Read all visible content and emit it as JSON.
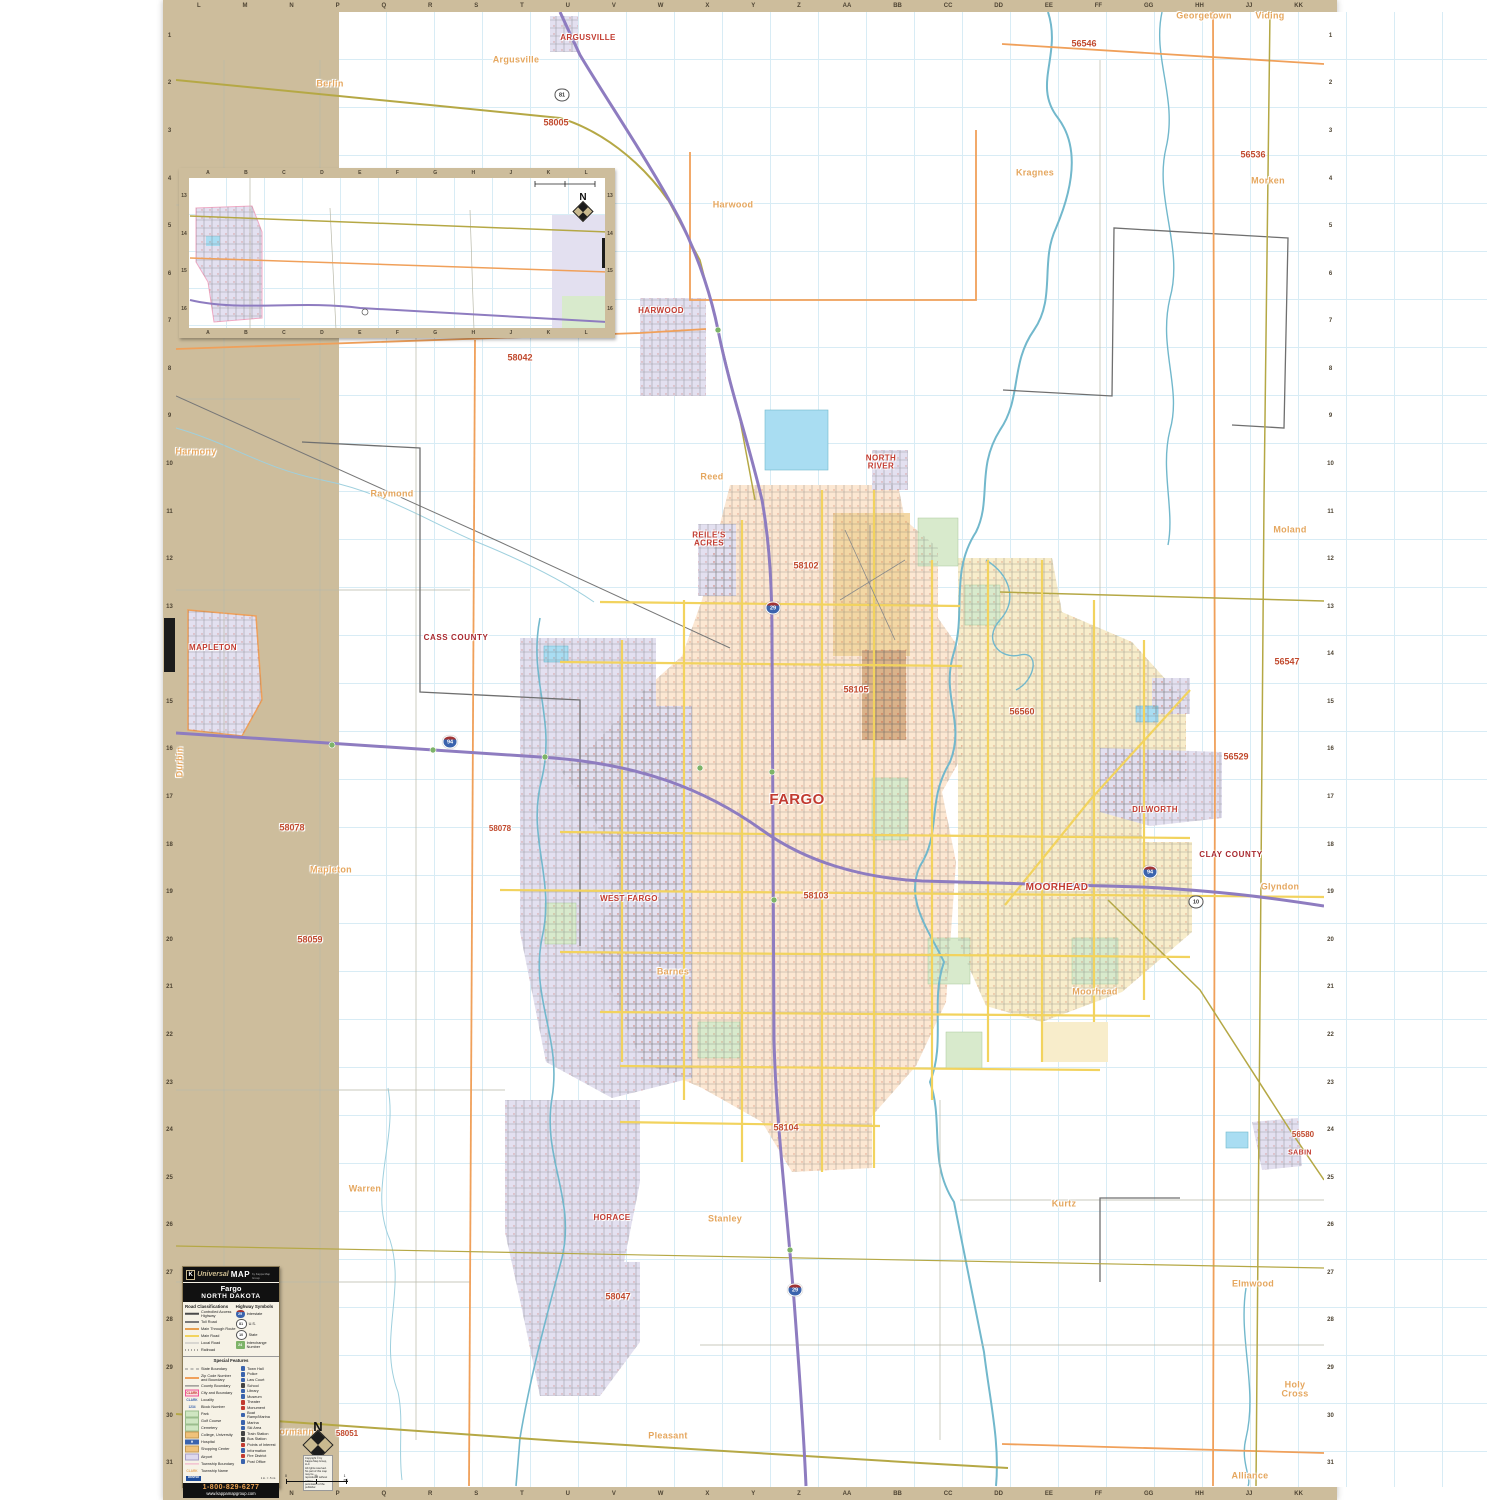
{
  "title": "Fargo North Dakota Wall Map",
  "colors": {
    "frame": "#cdbd9c",
    "urban_peach": "#fce7d2",
    "city_lavender": "#e3e0f0",
    "moorhead_yellow": "#f8edcb",
    "park_green": "#d8eacc",
    "water_cyan": "#a9ddf2",
    "river": "#72b8cc",
    "interstate_purple": "#8e7cc0",
    "main_road_yellow": "#f2d35e",
    "through_route_olive": "#b5a845",
    "zip_boundary_orange": "#f0a05a",
    "city_label_red": "#c23b30",
    "zip_label_red": "#c14a2e",
    "township_tan": "#e5a75f"
  },
  "north": {
    "label": "N"
  },
  "grid": {
    "top_letters": [
      "L",
      "M",
      "N",
      "P",
      "Q",
      "R",
      "S",
      "T",
      "U",
      "V",
      "W",
      "X",
      "Y",
      "Z",
      "AA",
      "BB",
      "CC",
      "DD",
      "EE",
      "FF",
      "GG",
      "HH",
      "JJ",
      "KK"
    ],
    "side_numbers": [
      "1",
      "2",
      "3",
      "4",
      "5",
      "6",
      "7",
      "8",
      "9",
      "10",
      "11",
      "12",
      "13",
      "14",
      "15",
      "16",
      "17",
      "18",
      "19",
      "20",
      "21",
      "22",
      "23",
      "24",
      "25",
      "26",
      "27",
      "28",
      "29",
      "30",
      "31"
    ]
  },
  "inset": {
    "letters": [
      "A",
      "B",
      "C",
      "D",
      "E",
      "F",
      "G",
      "H",
      "J",
      "K",
      "L"
    ],
    "numbers": [
      "13",
      "14",
      "15",
      "16"
    ]
  },
  "shields": [
    {
      "type": "interstate",
      "num": "29",
      "x": 773,
      "y": 608
    },
    {
      "type": "interstate",
      "num": "29",
      "x": 795,
      "y": 1290
    },
    {
      "type": "interstate",
      "num": "94",
      "x": 450,
      "y": 742
    },
    {
      "type": "interstate",
      "num": "94",
      "x": 1150,
      "y": 872
    },
    {
      "type": "us",
      "num": "81",
      "x": 562,
      "y": 95
    },
    {
      "type": "us",
      "num": "10",
      "x": 1196,
      "y": 902
    }
  ],
  "map_labels": [
    {
      "text": "ARGUSVILLE",
      "x": 588,
      "y": 38,
      "kind": "city",
      "size": 8
    },
    {
      "text": "Argusville",
      "x": 516,
      "y": 60,
      "kind": "twp"
    },
    {
      "text": "Berlin",
      "x": 330,
      "y": 84,
      "kind": "twp"
    },
    {
      "text": "58005",
      "x": 556,
      "y": 123,
      "kind": "zip"
    },
    {
      "text": "56546",
      "x": 1084,
      "y": 44,
      "kind": "zip"
    },
    {
      "text": "Georgetown",
      "x": 1204,
      "y": 16,
      "kind": "twp"
    },
    {
      "text": "Viding",
      "x": 1270,
      "y": 16,
      "kind": "twp"
    },
    {
      "text": "56536",
      "x": 1253,
      "y": 155,
      "kind": "zip"
    },
    {
      "text": "Kragnes",
      "x": 1035,
      "y": 173,
      "kind": "twp"
    },
    {
      "text": "Morken",
      "x": 1268,
      "y": 181,
      "kind": "twp"
    },
    {
      "text": "CASS COUNTY",
      "x": 357,
      "y": 188,
      "kind": "county",
      "size": 7
    },
    {
      "text": "Casselton",
      "x": 297,
      "y": 197,
      "kind": "twp",
      "size": 7
    },
    {
      "text": "Harmony",
      "x": 460,
      "y": 204,
      "kind": "twp",
      "size": 7
    },
    {
      "text": "58012",
      "x": 378,
      "y": 226,
      "kind": "zip",
      "size": 8
    },
    {
      "text": "CASSELTON",
      "x": 228,
      "y": 262,
      "kind": "city",
      "size": 7
    },
    {
      "text": "Everest",
      "x": 277,
      "y": 286,
      "kind": "twp",
      "size": 7
    },
    {
      "text": "58059",
      "x": 460,
      "y": 281,
      "kind": "zip",
      "size": 8
    },
    {
      "text": "Durbin",
      "x": 440,
      "y": 293,
      "kind": "twp",
      "size": 7
    },
    {
      "text": "MAPLETON",
      "x": 581,
      "y": 284,
      "kind": "city",
      "size": 6.5
    },
    {
      "text": "HARWOOD",
      "x": 661,
      "y": 311,
      "kind": "city",
      "size": 8
    },
    {
      "text": "Harwood",
      "x": 733,
      "y": 205,
      "kind": "twp"
    },
    {
      "text": "58042",
      "x": 520,
      "y": 358,
      "kind": "zip"
    },
    {
      "text": "Harmony",
      "x": 196,
      "y": 452,
      "kind": "twp"
    },
    {
      "text": "Raymond",
      "x": 392,
      "y": 494,
      "kind": "twp"
    },
    {
      "text": "Reed",
      "x": 712,
      "y": 477,
      "kind": "twp"
    },
    {
      "text": "NORTH\nRIVER",
      "x": 881,
      "y": 463,
      "kind": "city",
      "size": 8
    },
    {
      "text": "REILE'S\nACRES",
      "x": 709,
      "y": 540,
      "kind": "city",
      "size": 8
    },
    {
      "text": "58102",
      "x": 806,
      "y": 566,
      "kind": "zip"
    },
    {
      "text": "Moland",
      "x": 1290,
      "y": 530,
      "kind": "twp"
    },
    {
      "text": "CASS COUNTY",
      "x": 456,
      "y": 638,
      "kind": "county"
    },
    {
      "text": "MAPLETON",
      "x": 213,
      "y": 648,
      "kind": "city",
      "size": 8
    },
    {
      "text": "56547",
      "x": 1287,
      "y": 662,
      "kind": "zip"
    },
    {
      "text": "58105",
      "x": 856,
      "y": 690,
      "kind": "zip"
    },
    {
      "text": "56560",
      "x": 1022,
      "y": 712,
      "kind": "zip"
    },
    {
      "text": "56529",
      "x": 1236,
      "y": 757,
      "kind": "zip"
    },
    {
      "text": "Durbin",
      "x": 180,
      "y": 762,
      "kind": "twp",
      "rot": true
    },
    {
      "text": "FARGO",
      "x": 797,
      "y": 800,
      "kind": "city",
      "size": 15
    },
    {
      "text": "DILWORTH",
      "x": 1155,
      "y": 810,
      "kind": "city",
      "size": 8
    },
    {
      "text": "58078",
      "x": 292,
      "y": 828,
      "kind": "zip"
    },
    {
      "text": "58078",
      "x": 500,
      "y": 829,
      "kind": "zip",
      "size": 8
    },
    {
      "text": "CLAY COUNTY",
      "x": 1231,
      "y": 855,
      "kind": "county"
    },
    {
      "text": "Mapleton",
      "x": 331,
      "y": 870,
      "kind": "twp"
    },
    {
      "text": "Glyndon",
      "x": 1280,
      "y": 887,
      "kind": "twp"
    },
    {
      "text": "WEST FARGO",
      "x": 629,
      "y": 899,
      "kind": "city",
      "size": 8
    },
    {
      "text": "58103",
      "x": 816,
      "y": 896,
      "kind": "zip"
    },
    {
      "text": "MOORHEAD",
      "x": 1057,
      "y": 888,
      "kind": "city",
      "size": 10
    },
    {
      "text": "58059",
      "x": 310,
      "y": 940,
      "kind": "zip"
    },
    {
      "text": "Barnes",
      "x": 673,
      "y": 972,
      "kind": "twp"
    },
    {
      "text": "Moorhead",
      "x": 1095,
      "y": 992,
      "kind": "twp"
    },
    {
      "text": "58104",
      "x": 786,
      "y": 1128,
      "kind": "zip"
    },
    {
      "text": "56580",
      "x": 1303,
      "y": 1135,
      "kind": "zip",
      "size": 8
    },
    {
      "text": "SABIN",
      "x": 1300,
      "y": 1153,
      "kind": "city",
      "size": 7
    },
    {
      "text": "Warren",
      "x": 365,
      "y": 1189,
      "kind": "twp"
    },
    {
      "text": "HORACE",
      "x": 612,
      "y": 1218,
      "kind": "city",
      "size": 8
    },
    {
      "text": "Stanley",
      "x": 725,
      "y": 1219,
      "kind": "twp"
    },
    {
      "text": "Kurtz",
      "x": 1064,
      "y": 1204,
      "kind": "twp"
    },
    {
      "text": "58047",
      "x": 618,
      "y": 1297,
      "kind": "zip"
    },
    {
      "text": "Elmwood",
      "x": 1253,
      "y": 1284,
      "kind": "twp"
    },
    {
      "text": "Holy\nCross",
      "x": 1295,
      "y": 1390,
      "kind": "twp"
    },
    {
      "text": "Normanna",
      "x": 296,
      "y": 1432,
      "kind": "twp"
    },
    {
      "text": "58051",
      "x": 347,
      "y": 1434,
      "kind": "zip",
      "size": 8
    },
    {
      "text": "Pleasant",
      "x": 668,
      "y": 1436,
      "kind": "twp"
    },
    {
      "text": "Alliance",
      "x": 1250,
      "y": 1476,
      "kind": "twp"
    }
  ],
  "legend": {
    "brand": {
      "k": "K",
      "universal": "Universal",
      "map": "MAP",
      "tagline": "by Kappa Map Group"
    },
    "title": "Fargo",
    "subtitle": "NORTH DAKOTA",
    "road_class_header": "Road Classifications",
    "road_classes": [
      {
        "label": "Controlled Access Highway",
        "swatch": "controlled"
      },
      {
        "label": "Toll Road",
        "swatch": "toll"
      },
      {
        "label": "Main Through Route",
        "swatch": "through"
      },
      {
        "label": "Main Road",
        "swatch": "main"
      },
      {
        "label": "Local Road",
        "swatch": "local"
      },
      {
        "label": "Railroad",
        "swatch": "rail"
      }
    ],
    "highway_header": "Highway Symbols",
    "highway_symbols": [
      {
        "label": "Interstate",
        "shape": "interstate",
        "num": "29"
      },
      {
        "label": "U.S.",
        "shape": "us",
        "num": "81"
      },
      {
        "label": "State",
        "shape": "state",
        "num": "10"
      },
      {
        "label": "Interchange Number",
        "shape": "interchange",
        "num": "24"
      }
    ],
    "special_header": "Special Features",
    "special_left": [
      {
        "label": "State Boundary",
        "swatch": "state-b"
      },
      {
        "label": "Zip Code Number and Boundary",
        "swatch": "zip-b"
      },
      {
        "label": "County Boundary",
        "swatch": "county-b"
      },
      {
        "label": "City and Boundary",
        "swatch": "city-b",
        "sample": "CLARK"
      },
      {
        "label": "Locality",
        "swatch": "locality",
        "sample": "CLARK"
      },
      {
        "label": "Block Number",
        "swatch": "block",
        "sample": "1234"
      },
      {
        "label": "Park",
        "swatch": "park"
      },
      {
        "label": "Golf Course",
        "swatch": "golf"
      },
      {
        "label": "Cemetery",
        "swatch": "cem"
      },
      {
        "label": "College, University",
        "swatch": "college"
      },
      {
        "label": "Hospital",
        "swatch": "hosp",
        "sample": "H"
      },
      {
        "label": "Shopping Center",
        "swatch": "shop"
      },
      {
        "label": "Airport",
        "swatch": "airport"
      },
      {
        "label": "Township Boundary",
        "swatch": "twp-b"
      },
      {
        "label": "Township Name",
        "swatch": "twp-n",
        "sample": "CLARK"
      }
    ],
    "special_right": [
      {
        "label": "Town Hall",
        "c": "#3a63ad"
      },
      {
        "label": "Police",
        "c": "#3a63ad"
      },
      {
        "label": "Law Court",
        "c": "#3a63ad"
      },
      {
        "label": "School",
        "c": "#444444"
      },
      {
        "label": "Library",
        "c": "#3a63ad"
      },
      {
        "label": "Museum",
        "c": "#3a63ad"
      },
      {
        "label": "Theater",
        "c": "#c23b30"
      },
      {
        "label": "Monument",
        "c": "#c23b30"
      },
      {
        "label": "Boat Ramp/Marina",
        "c": "#3a63ad"
      },
      {
        "label": "Marina",
        "c": "#3a63ad"
      },
      {
        "label": "Ski Area",
        "c": "#3a63ad"
      },
      {
        "label": "Train Station",
        "c": "#444444"
      },
      {
        "label": "Bus Station",
        "c": "#444444"
      },
      {
        "label": "Points of Interest",
        "c": "#c23b30"
      },
      {
        "label": "Information",
        "c": "#3a63ad"
      },
      {
        "label": "Fire District",
        "c": "#c23b30"
      },
      {
        "label": "Post Office",
        "c": "#3a63ad"
      }
    ],
    "wanted": "WANTED",
    "scale_note": "1 in. = .5 mi.",
    "phone": "1-800-829-6277",
    "website": "www.kappamapgroup.com"
  },
  "annotations": {
    "copyright_lines": [
      "Copyright © by",
      "Kappa Map Group, LLC",
      "All rights reserved.",
      "No part of this map may be",
      "reproduced without written",
      "permission of the publisher."
    ],
    "scale_bar_labels": [
      "0",
      "½",
      "1 mi."
    ]
  }
}
